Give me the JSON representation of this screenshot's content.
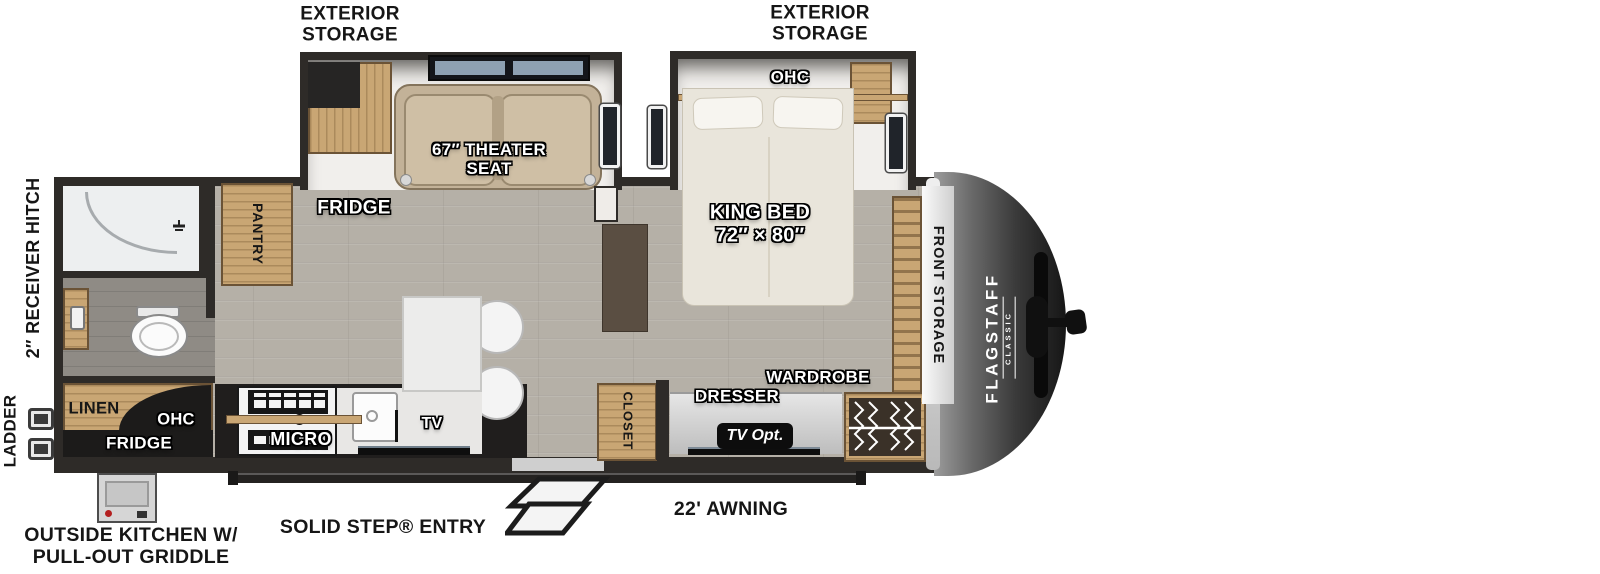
{
  "exterior": {
    "exterior_storage_left": "EXTERIOR\nSTORAGE",
    "exterior_storage_right": "EXTERIOR\nSTORAGE",
    "receiver_hitch": "2″ RECEIVER HITCH",
    "ladder": "LADDER",
    "outside_kitchen": "OUTSIDE KITCHEN W/\nPULL-OUT GRIDDLE",
    "solid_step_entry": "SOLID STEP® ENTRY",
    "awning": "22' AWNING"
  },
  "bathroom": {
    "linen": "LINEN",
    "ohc": "OHC",
    "outside_fridge": "FRIDGE",
    "pantry": "PANTRY"
  },
  "living": {
    "fridge": "FRIDGE",
    "theater_seat": "67″ THEATER\nSEAT",
    "micro": "MICRO",
    "tv": "TV"
  },
  "bedroom": {
    "king_bed": "KING BED\n72″ × 80″",
    "ohc": "OHC",
    "closet": "CLOSET",
    "dresser": "DRESSER",
    "tv_opt": "TV Opt.",
    "wardrobe": "WARDROBE",
    "front_storage": "FRONT STORAGE"
  },
  "brand": {
    "name": "FLAGSTAFF",
    "series": "CLASSIC"
  },
  "colors": {
    "wall": "#2e2b28",
    "wood": "#c9a674",
    "floor": "#b5b0a7",
    "label_white": "#ffffff",
    "label_black": "#161616"
  }
}
